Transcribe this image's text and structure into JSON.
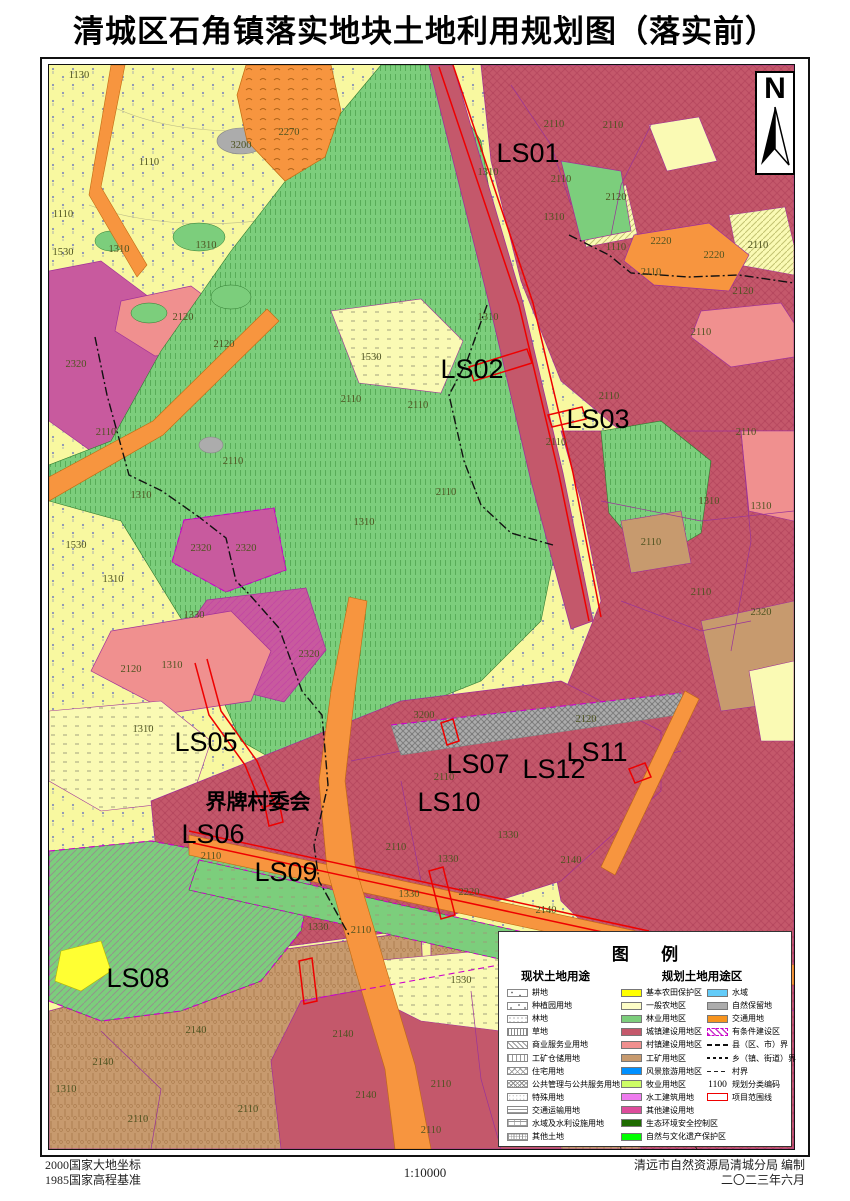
{
  "title": "清城区石角镇落实地块土地利用规划图（落实前）",
  "compass": {
    "label": "N"
  },
  "footer": {
    "datum1": "2000国家大地坐标",
    "datum2": "1985国家高程基准",
    "scale": "1:10000",
    "credit1": "清远市自然资源局清城分局 编制",
    "credit2": "二〇二三年六月"
  },
  "legend": {
    "title": "图 例",
    "current_header": "现状土地用途",
    "planned_header": "规划土地用途区",
    "current_items": [
      {
        "label": "耕地",
        "pattern": "p-dots3"
      },
      {
        "label": "种植园用地",
        "pattern": "p-dots3b"
      },
      {
        "label": "林地",
        "pattern": "p-dotsp"
      },
      {
        "label": "草地",
        "pattern": "p-grass"
      },
      {
        "label": "商业服务业用地",
        "pattern": "p-diag"
      },
      {
        "label": "工矿仓储用地",
        "pattern": "p-vlin"
      },
      {
        "label": "住宅用地",
        "pattern": "p-diam"
      },
      {
        "label": "公共管理与公共服务用地",
        "pattern": "p-diam2"
      },
      {
        "label": "特殊用地",
        "pattern": "p-faint"
      },
      {
        "label": "交通运输用地",
        "pattern": "p-hlin"
      },
      {
        "label": "水域及水利设施用地",
        "pattern": "p-brick"
      },
      {
        "label": "其他土地",
        "pattern": "p-cross"
      }
    ],
    "planned_items": [
      {
        "label": "基本农田保护区",
        "color": "#FFFF00"
      },
      {
        "label": "一般农地区",
        "color": "#FCFCC6"
      },
      {
        "label": "林业用地区",
        "color": "#7CCE7C"
      },
      {
        "label": "城镇建设用地区",
        "color": "#C4586B"
      },
      {
        "label": "村镇建设用地区",
        "color": "#F0908F"
      },
      {
        "label": "工矿用地区",
        "color": "#C79A6E"
      },
      {
        "label": "风景旅游用地区",
        "color": "#0090FF"
      },
      {
        "label": "牧业用地区",
        "color": "#CDFC66"
      },
      {
        "label": "水工建筑用地",
        "color": "#EE7BEE"
      },
      {
        "label": "其他建设用地",
        "color": "#DD4C9B"
      },
      {
        "label": "生态环境安全控制区",
        "color": "#1E6B00"
      },
      {
        "label": "自然与文化遗产保护区",
        "color": "#00FF00"
      }
    ],
    "right_items": [
      {
        "label": "水域",
        "type": "swatch",
        "color": "#63CCF9"
      },
      {
        "label": "自然保留地",
        "type": "swatch",
        "color": "#ACACAC"
      },
      {
        "label": "交通用地",
        "type": "swatch",
        "color": "#F7941E"
      },
      {
        "label": "有条件建设区",
        "type": "cond"
      },
      {
        "label": "县（区、市）界",
        "type": "line1"
      },
      {
        "label": "乡（镇、街道）界",
        "type": "line2"
      },
      {
        "label": "村界",
        "type": "line3"
      },
      {
        "label": "规划分类编码",
        "type": "code",
        "text": "1100"
      },
      {
        "label": "项目范围线",
        "type": "redbox"
      }
    ]
  },
  "map": {
    "ls_labels": [
      {
        "x": 479,
        "y": 88,
        "t": "LS01"
      },
      {
        "x": 423,
        "y": 304,
        "t": "LS02"
      },
      {
        "x": 549,
        "y": 354,
        "t": "LS03"
      },
      {
        "x": 157,
        "y": 677,
        "t": "LS05"
      },
      {
        "x": 164,
        "y": 769,
        "t": "LS06"
      },
      {
        "x": 429,
        "y": 699,
        "t": "LS07"
      },
      {
        "x": 89,
        "y": 913,
        "t": "LS08"
      },
      {
        "x": 237,
        "y": 807,
        "t": "LS09"
      },
      {
        "x": 400,
        "y": 737,
        "t": "LS10"
      },
      {
        "x": 548,
        "y": 687,
        "t": "LS11"
      },
      {
        "x": 505,
        "y": 704,
        "t": "LS12"
      }
    ],
    "place_labels": [
      {
        "x": 209,
        "y": 736,
        "t": "界牌村委会"
      }
    ],
    "codes": [
      {
        "x": 30,
        "y": 9,
        "t": "1130"
      },
      {
        "x": 100,
        "y": 96,
        "t": "1110"
      },
      {
        "x": 14,
        "y": 148,
        "t": "1110"
      },
      {
        "x": 240,
        "y": 66,
        "t": "2270"
      },
      {
        "x": 192,
        "y": 79,
        "t": "3200"
      },
      {
        "x": 157,
        "y": 179,
        "t": "1310"
      },
      {
        "x": 70,
        "y": 183,
        "t": "1310"
      },
      {
        "x": 14,
        "y": 186,
        "t": "1530"
      },
      {
        "x": 134,
        "y": 251,
        "t": "2120"
      },
      {
        "x": 175,
        "y": 278,
        "t": "2120"
      },
      {
        "x": 27,
        "y": 298,
        "t": "2320"
      },
      {
        "x": 57,
        "y": 366,
        "t": "2110"
      },
      {
        "x": 184,
        "y": 395,
        "t": "2110"
      },
      {
        "x": 92,
        "y": 429,
        "t": "1310"
      },
      {
        "x": 27,
        "y": 479,
        "t": "1530"
      },
      {
        "x": 152,
        "y": 482,
        "t": "2320"
      },
      {
        "x": 197,
        "y": 482,
        "t": "2320"
      },
      {
        "x": 260,
        "y": 588,
        "t": "2320"
      },
      {
        "x": 82,
        "y": 603,
        "t": "2120"
      },
      {
        "x": 145,
        "y": 549,
        "t": "1330"
      },
      {
        "x": 123,
        "y": 599,
        "t": "1310"
      },
      {
        "x": 64,
        "y": 513,
        "t": "1310"
      },
      {
        "x": 322,
        "y": 291,
        "t": "1530"
      },
      {
        "x": 302,
        "y": 333,
        "t": "2110"
      },
      {
        "x": 369,
        "y": 339,
        "t": "2110"
      },
      {
        "x": 315,
        "y": 456,
        "t": "1310"
      },
      {
        "x": 439,
        "y": 251,
        "t": "1310"
      },
      {
        "x": 397,
        "y": 426,
        "t": "2110"
      },
      {
        "x": 505,
        "y": 58,
        "t": "2110"
      },
      {
        "x": 564,
        "y": 59,
        "t": "2110"
      },
      {
        "x": 512,
        "y": 113,
        "t": "2110"
      },
      {
        "x": 567,
        "y": 131,
        "t": "2120"
      },
      {
        "x": 505,
        "y": 151,
        "t": "1310"
      },
      {
        "x": 439,
        "y": 106,
        "t": "1310"
      },
      {
        "x": 567,
        "y": 181,
        "t": "1110"
      },
      {
        "x": 612,
        "y": 175,
        "t": "2220"
      },
      {
        "x": 665,
        "y": 189,
        "t": "2220"
      },
      {
        "x": 709,
        "y": 179,
        "t": "2110"
      },
      {
        "x": 694,
        "y": 225,
        "t": "2120"
      },
      {
        "x": 507,
        "y": 376,
        "t": "2110"
      },
      {
        "x": 560,
        "y": 330,
        "t": "2110"
      },
      {
        "x": 602,
        "y": 206,
        "t": "2110"
      },
      {
        "x": 652,
        "y": 266,
        "t": "2110"
      },
      {
        "x": 697,
        "y": 366,
        "t": "2110"
      },
      {
        "x": 660,
        "y": 435,
        "t": "1310"
      },
      {
        "x": 712,
        "y": 440,
        "t": "1310"
      },
      {
        "x": 602,
        "y": 476,
        "t": "2110"
      },
      {
        "x": 652,
        "y": 526,
        "t": "2110"
      },
      {
        "x": 712,
        "y": 546,
        "t": "2320"
      },
      {
        "x": 94,
        "y": 663,
        "t": "1310"
      },
      {
        "x": 375,
        "y": 649,
        "t": "3200"
      },
      {
        "x": 537,
        "y": 653,
        "t": "2120"
      },
      {
        "x": 395,
        "y": 711,
        "t": "2110"
      },
      {
        "x": 162,
        "y": 790,
        "t": "2110"
      },
      {
        "x": 269,
        "y": 861,
        "t": "1330"
      },
      {
        "x": 360,
        "y": 828,
        "t": "1330"
      },
      {
        "x": 399,
        "y": 793,
        "t": "1330"
      },
      {
        "x": 459,
        "y": 769,
        "t": "1330"
      },
      {
        "x": 347,
        "y": 781,
        "t": "2110"
      },
      {
        "x": 312,
        "y": 864,
        "t": "2110"
      },
      {
        "x": 420,
        "y": 826,
        "t": "2220"
      },
      {
        "x": 412,
        "y": 914,
        "t": "1530"
      },
      {
        "x": 522,
        "y": 794,
        "t": "2140"
      },
      {
        "x": 497,
        "y": 844,
        "t": "2140"
      },
      {
        "x": 147,
        "y": 964,
        "t": "2140"
      },
      {
        "x": 54,
        "y": 996,
        "t": "2140"
      },
      {
        "x": 294,
        "y": 968,
        "t": "2140"
      },
      {
        "x": 317,
        "y": 1029,
        "t": "2140"
      },
      {
        "x": 89,
        "y": 1053,
        "t": "2110"
      },
      {
        "x": 199,
        "y": 1043,
        "t": "2110"
      },
      {
        "x": 17,
        "y": 1023,
        "t": "1310"
      },
      {
        "x": 392,
        "y": 1018,
        "t": "2110"
      },
      {
        "x": 382,
        "y": 1064,
        "t": "2110"
      },
      {
        "x": 692,
        "y": 1000,
        "t": "2110"
      }
    ]
  },
  "colors": {
    "bg_yellow": "#F8F8A0",
    "green": "#7CCE7C",
    "rose": "#C4586B",
    "salmon": "#F0908F",
    "tan": "#C79A6E",
    "orange": "#F7953F",
    "magenta": "#C85A9E",
    "gray": "#ACACAC",
    "pale": "#FAFAB4",
    "bright_yellow": "#FFFF33",
    "red_line": "#EE0000",
    "purple_line": "#993399"
  }
}
